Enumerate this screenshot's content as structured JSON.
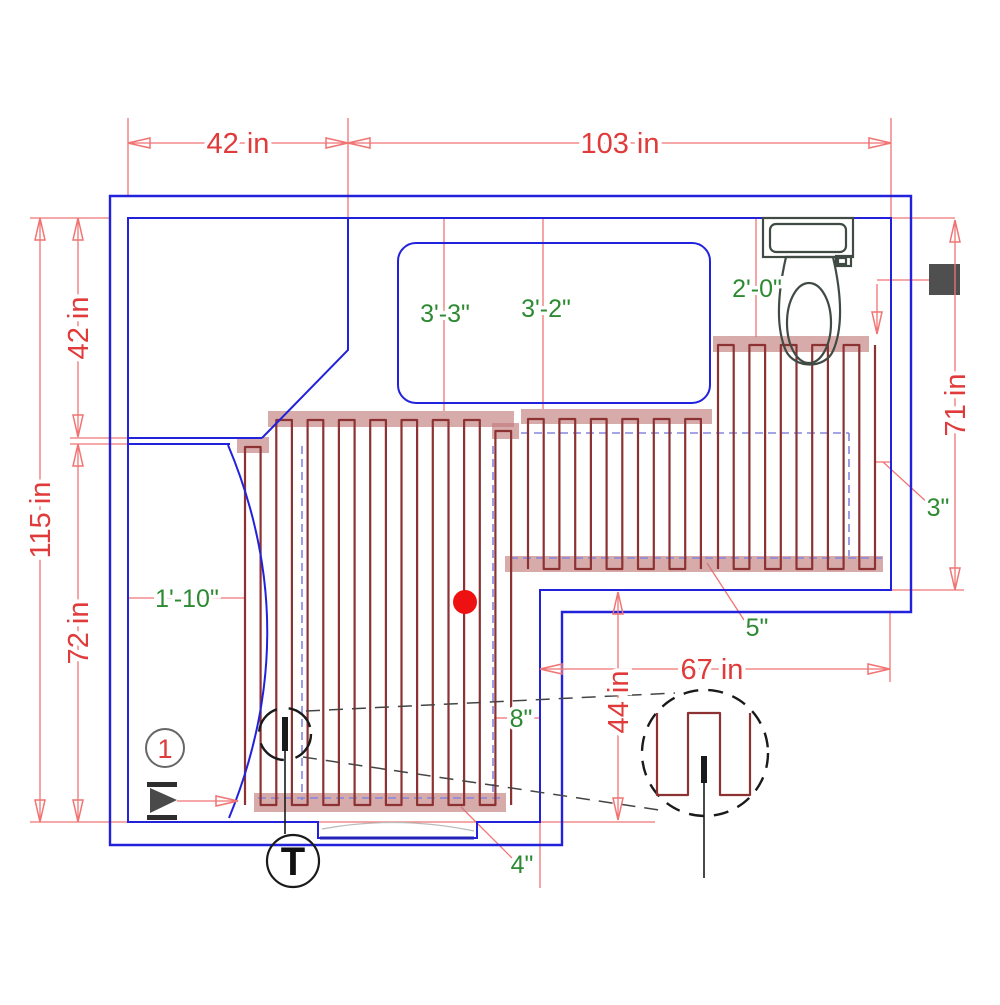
{
  "plan": {
    "dimensions": {
      "top_width_left": "42 in",
      "top_width_right": "103 in",
      "left_height_total": "115 in",
      "left_height_upper": "42 in",
      "left_height_lower": "72 in",
      "right_height": "71 in",
      "lower_width": "67 in",
      "lower_height": "44 in"
    },
    "clearances": {
      "tub_left": "3'-3\"",
      "tub_right": "3'-2\"",
      "toilet_center": "2'-0\"",
      "closet_width": "1'-10\"",
      "wall_clearance": "3\"",
      "mat_edge_clearance": "5\"",
      "mat_gap": "8\"",
      "door_clearance": "4\""
    },
    "callouts": {
      "mat_number": "1",
      "thermostat": "T"
    },
    "colors": {
      "wall": "#2222dd",
      "dimension_line": "#f07474",
      "dimension_text": "#e03a3a",
      "clearance_text": "#2d8a33",
      "heating_cable": "#8d3232",
      "mat_tape": "#cf9797",
      "sensor_dot": "#ee1111",
      "fixture_outline": "#3f4b43",
      "junction_box": "#4f4f4f"
    }
  }
}
